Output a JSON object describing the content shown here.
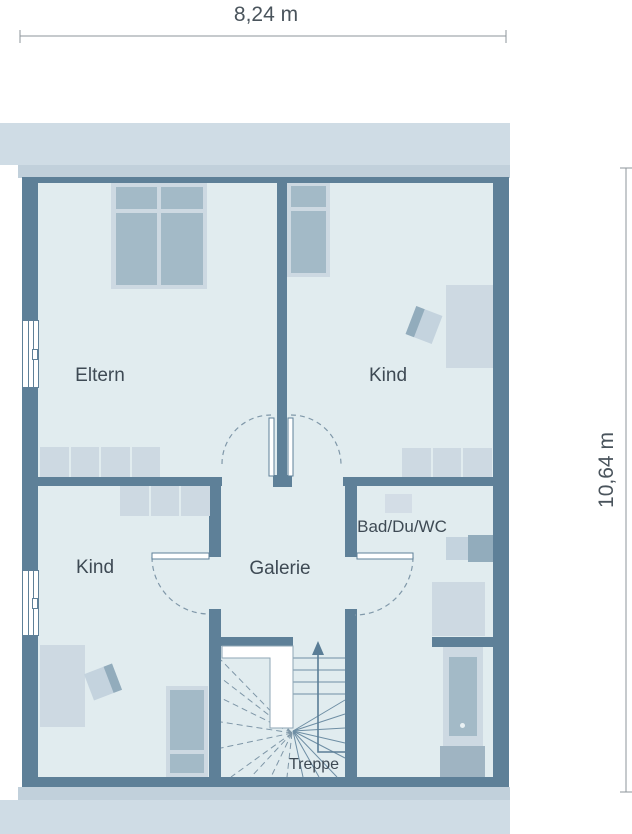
{
  "dimensions": {
    "width": "8,24 m",
    "height": "10,64 m"
  },
  "rooms": {
    "eltern": "Eltern",
    "kind_top": "Kind",
    "kind_bottom": "Kind",
    "bath": "Bad/Du/WC",
    "galerie": "Galerie",
    "stairs": "Treppe"
  },
  "colors": {
    "wall": "#5e8098",
    "floor": "#e1ecef",
    "furniture_light": "#cdd9e2",
    "furniture_medium": "#a3bac7",
    "furniture_dark": "#92acbc",
    "roof_band_light": "#cfdce5",
    "roof_band_dark": "#c1d0db",
    "label_text": "#3e4a54",
    "dashed_line": "#8098a9",
    "stair_line": "#6e8ea4",
    "dimension_line": "#8d959b",
    "window_fill": "#ffffff"
  }
}
